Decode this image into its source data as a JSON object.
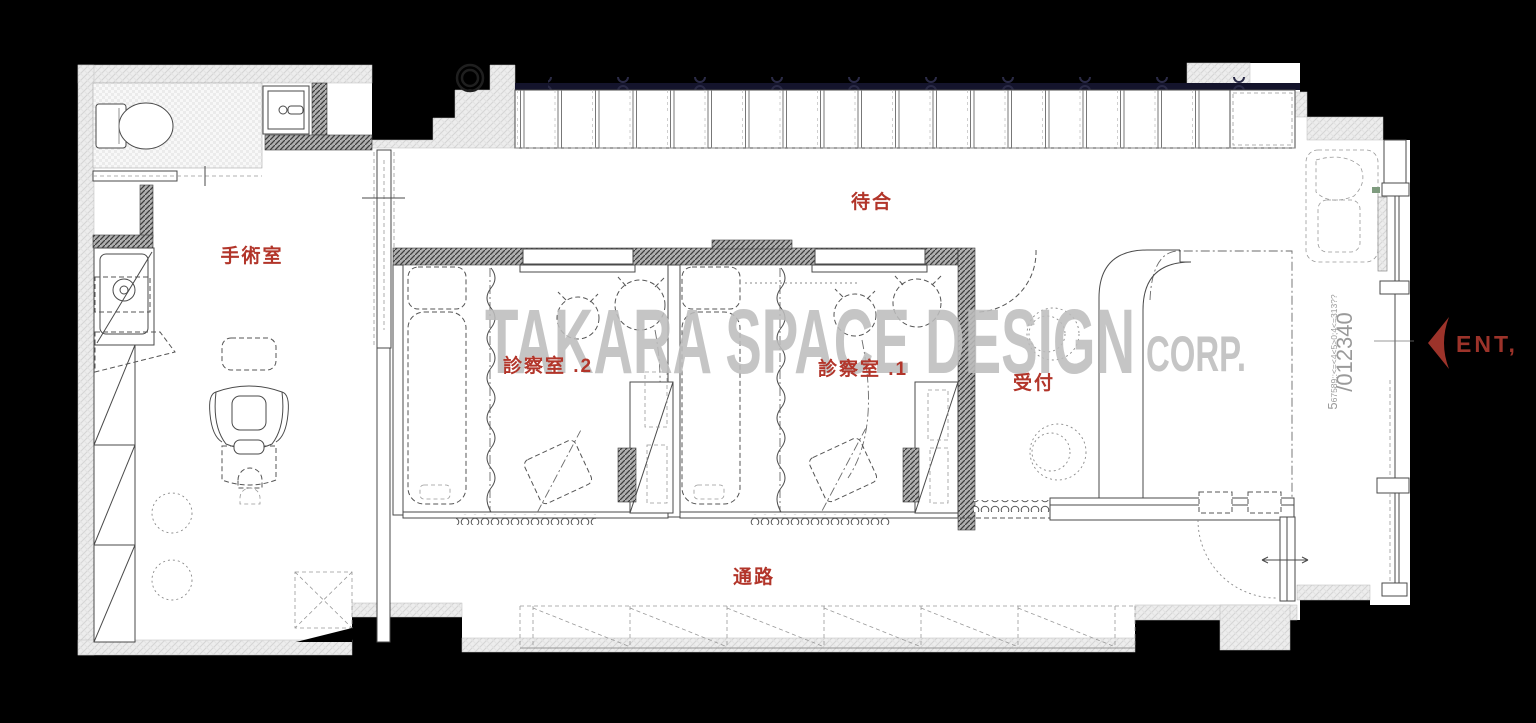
{
  "title": "clinic-floor-plan",
  "labels": {
    "surgery": "手術室",
    "waiting": "待合",
    "exam2": "診察室 .2",
    "exam1": "診察室 .1",
    "reception": "受付",
    "corridor": "通路"
  },
  "entrance": {
    "label": "ENT,"
  },
  "watermark": {
    "line1": "TAKARA SPACE DESIGN",
    "line2": "CORP."
  },
  "side_text": {
    "large": "/012340",
    "small_lead": "5",
    "small_rest": "67589::<=<4<5>0;4<=313??"
  },
  "colors": {
    "background": "#000000",
    "label_red": "#b2352a",
    "watermark_gray": "#bdbdbd",
    "navy_band": "#14142c",
    "entrance_red": "#9c332a"
  }
}
